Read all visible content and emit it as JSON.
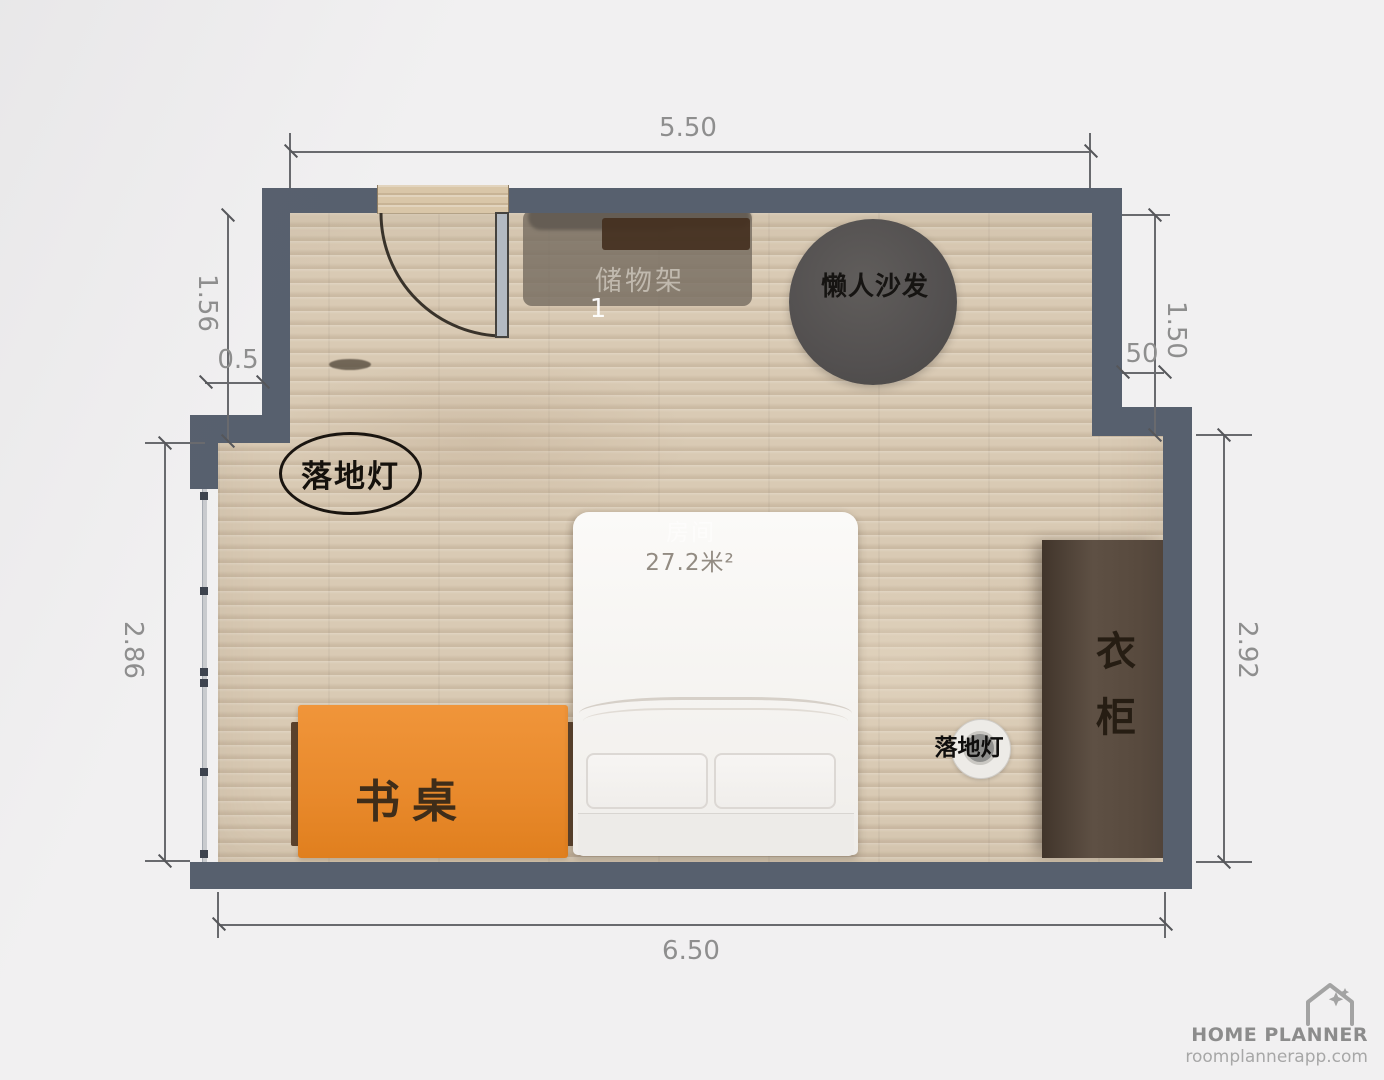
{
  "watermark": {
    "brand": "HOME PLANNER",
    "website": "roomplannerapp.com"
  },
  "room": {
    "name": "房间",
    "area": "27.2米²"
  },
  "dimensions": {
    "top": "5.50",
    "bottom": "6.50",
    "left_upper": "1.56",
    "left_step": "0.5",
    "left_lower": "2.86",
    "right_upper": "1.50",
    "right_step": "50",
    "right_lower": "2.92"
  },
  "furniture": {
    "storage_shelf": {
      "label": "储物架",
      "index": "1"
    },
    "bean_bag": {
      "label": "懒人沙发"
    },
    "floor_lamp_left": {
      "label": "落地灯"
    },
    "floor_lamp_right": {
      "label": "落地灯"
    },
    "desk": {
      "label": "书桌"
    },
    "wardrobe": {
      "label": "衣柜"
    }
  },
  "colors": {
    "wall": "#57606e",
    "floor": "#d9cab4",
    "desk": "#e8892b",
    "wardrobe": "#51443a",
    "dimension_text": "#8e8e8e"
  }
}
